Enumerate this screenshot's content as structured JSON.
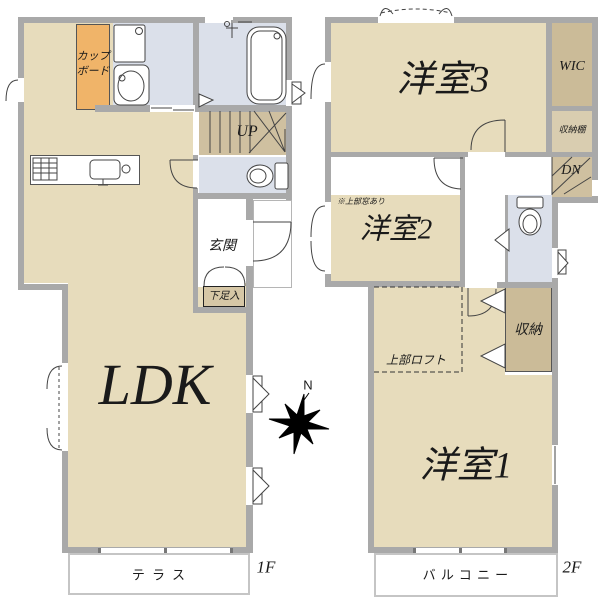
{
  "plan": {
    "floor1": {
      "floor_label": "1F",
      "ldk": "LDK",
      "cupboard_line1": "カップ",
      "cupboard_line2": "ボード",
      "stairs_up": "UP",
      "entrance": "玄関",
      "shoe_cabinet": "下足入",
      "terrace": "テラス"
    },
    "floor2": {
      "floor_label": "2F",
      "room3": "洋室3",
      "wic": "WIC",
      "storage_shelf": "収納棚",
      "stairs_down": "DN",
      "room2": "洋室2",
      "room2_note": "※上部窓あり",
      "loft": "上部ロフト",
      "closet": "収納",
      "room1": "洋室1",
      "balcony": "バルコニー"
    },
    "compass_north": "N",
    "colors": {
      "wall": "#a9a9a9",
      "room_beige": "#e7dcbc",
      "dark_beige": "#cfc0a0",
      "wet_blue": "#dbe0ea",
      "cupboard_orange": "#f0b469",
      "line": "#444444"
    }
  }
}
